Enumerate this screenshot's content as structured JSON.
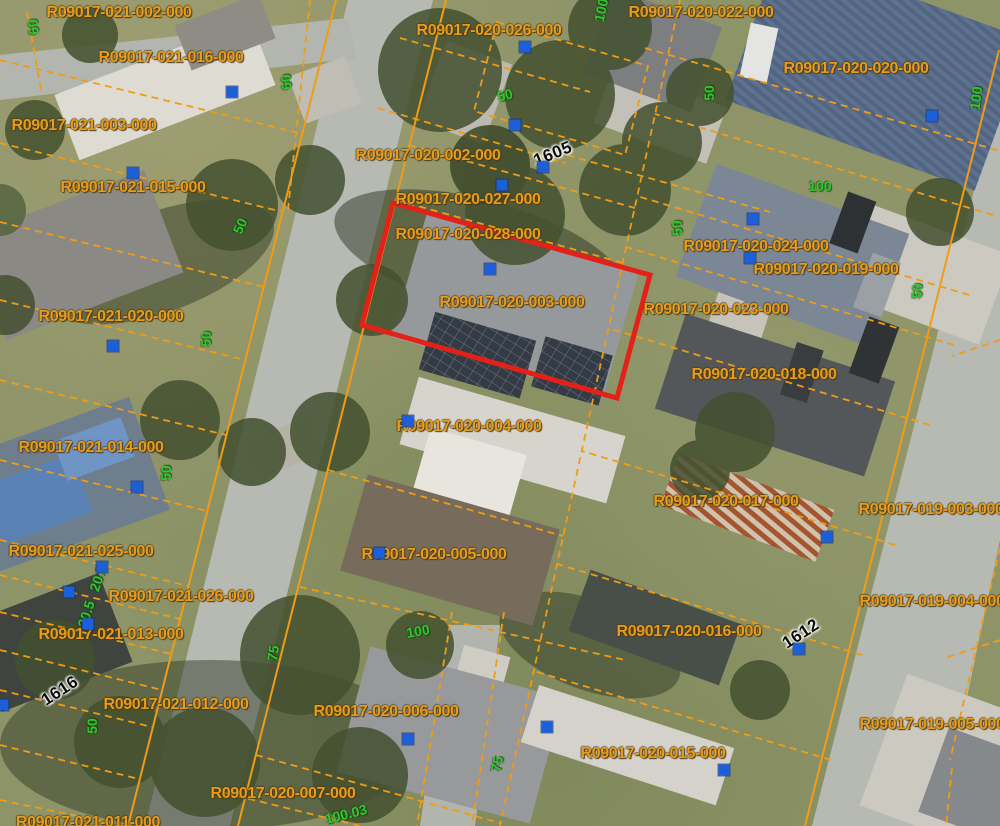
{
  "map": {
    "description": "aerial parcel map with GIS overlay",
    "colors": {
      "parcel_line": "#ef9c17",
      "parcel_label": "#e89b1c",
      "dimension_label": "#2fc82f",
      "address_label": "#0c0c0c",
      "marker": "#1d5fd8",
      "highlight": "#e32119"
    }
  },
  "highlighted_parcel": {
    "id": "R09017-020-003-000"
  },
  "parcel_labels": [
    {
      "text": "R09017-021-002-000",
      "x": 119,
      "y": 13
    },
    {
      "text": "R09017-020-026-000",
      "x": 489,
      "y": 31
    },
    {
      "text": "R09017-020-022-000",
      "x": 701,
      "y": 13
    },
    {
      "text": "R09017-021-016-000",
      "x": 171,
      "y": 58
    },
    {
      "text": "R09017-020-020-000",
      "x": 856,
      "y": 69
    },
    {
      "text": "R09017-021-003-000",
      "x": 84,
      "y": 126
    },
    {
      "text": "R09017-020-002-000",
      "x": 428,
      "y": 156
    },
    {
      "text": "R09017-021-015-000",
      "x": 133,
      "y": 188
    },
    {
      "text": "R09017-020-027-000",
      "x": 468,
      "y": 200
    },
    {
      "text": "R09017-020-028-000",
      "x": 468,
      "y": 235
    },
    {
      "text": "R09017-020-024-000",
      "x": 756,
      "y": 247
    },
    {
      "text": "R09017-020-019-000",
      "x": 826,
      "y": 270
    },
    {
      "text": "R09017-020-003-000",
      "x": 512,
      "y": 303
    },
    {
      "text": "R09017-020-023-000",
      "x": 716,
      "y": 310
    },
    {
      "text": "R09017-021-020-000",
      "x": 111,
      "y": 317
    },
    {
      "text": "R09017-020-018-000",
      "x": 764,
      "y": 375
    },
    {
      "text": "R09017-021-014-000",
      "x": 91,
      "y": 448
    },
    {
      "text": "R09017-020-004-000",
      "x": 469,
      "y": 427
    },
    {
      "text": "R09017-020-017-000",
      "x": 726,
      "y": 502
    },
    {
      "text": "R09017-019-003-000",
      "x": 931,
      "y": 510
    },
    {
      "text": "R09017-021-025-000",
      "x": 81,
      "y": 552
    },
    {
      "text": "R09017-020-005-000",
      "x": 434,
      "y": 555
    },
    {
      "text": "R09017-021-026-000",
      "x": 181,
      "y": 597
    },
    {
      "text": "R09017-019-004-000",
      "x": 932,
      "y": 602
    },
    {
      "text": "R09017-020-016-000",
      "x": 689,
      "y": 632
    },
    {
      "text": "R09017-021-013-000",
      "x": 111,
      "y": 635
    },
    {
      "text": "R09017-021-012-000",
      "x": 176,
      "y": 705
    },
    {
      "text": "R09017-020-006-000",
      "x": 386,
      "y": 712
    },
    {
      "text": "R09017-019-005-000",
      "x": 932,
      "y": 725
    },
    {
      "text": "R09017-020-015-000",
      "x": 653,
      "y": 754
    },
    {
      "text": "R09017-020-007-000",
      "x": 283,
      "y": 794
    },
    {
      "text": "R09017-021-011-000",
      "x": 88,
      "y": 823
    }
  ],
  "dimension_labels": [
    {
      "text": "60",
      "x": 33,
      "y": 27,
      "rot": -97
    },
    {
      "text": "60",
      "x": 286,
      "y": 82,
      "rot": -95
    },
    {
      "text": "100",
      "x": 601,
      "y": 10,
      "rot": -78
    },
    {
      "text": "50",
      "x": 505,
      "y": 95,
      "rot": -15
    },
    {
      "text": "50",
      "x": 709,
      "y": 93,
      "rot": -90
    },
    {
      "text": "100",
      "x": 976,
      "y": 98,
      "rot": -83
    },
    {
      "text": "100",
      "x": 820,
      "y": 186,
      "rot": 0
    },
    {
      "text": "50",
      "x": 677,
      "y": 228,
      "rot": -92
    },
    {
      "text": "50",
      "x": 240,
      "y": 226,
      "rot": -65
    },
    {
      "text": "50",
      "x": 917,
      "y": 291,
      "rot": -87
    },
    {
      "text": "50",
      "x": 206,
      "y": 339,
      "rot": -90
    },
    {
      "text": "50",
      "x": 166,
      "y": 473,
      "rot": -90
    },
    {
      "text": "20.5",
      "x": 98,
      "y": 578,
      "rot": -72
    },
    {
      "text": "20.5",
      "x": 86,
      "y": 614,
      "rot": -72
    },
    {
      "text": "100",
      "x": 418,
      "y": 631,
      "rot": -10
    },
    {
      "text": "75",
      "x": 273,
      "y": 653,
      "rot": -82
    },
    {
      "text": "50",
      "x": 92,
      "y": 726,
      "rot": -90
    },
    {
      "text": "75",
      "x": 497,
      "y": 764,
      "rot": -78
    },
    {
      "text": "100.03",
      "x": 346,
      "y": 814,
      "rot": -14
    }
  ],
  "address_labels": [
    {
      "text": "1605",
      "x": 553,
      "y": 154,
      "rot": -22
    },
    {
      "text": "1612",
      "x": 801,
      "y": 634,
      "rot": -33
    },
    {
      "text": "1616",
      "x": 60,
      "y": 691,
      "rot": -33
    }
  ],
  "markers": [
    {
      "x": 515,
      "y": 125
    },
    {
      "x": 543,
      "y": 167
    },
    {
      "x": 502,
      "y": 185
    },
    {
      "x": 232,
      "y": 92
    },
    {
      "x": 133,
      "y": 173
    },
    {
      "x": 525,
      "y": 47
    },
    {
      "x": 490,
      "y": 269
    },
    {
      "x": 753,
      "y": 219
    },
    {
      "x": 750,
      "y": 258
    },
    {
      "x": 932,
      "y": 116
    },
    {
      "x": 113,
      "y": 346
    },
    {
      "x": 137,
      "y": 487
    },
    {
      "x": 408,
      "y": 421
    },
    {
      "x": 379,
      "y": 553
    },
    {
      "x": 827,
      "y": 537
    },
    {
      "x": 102,
      "y": 567
    },
    {
      "x": 69,
      "y": 592
    },
    {
      "x": 88,
      "y": 624
    },
    {
      "x": 799,
      "y": 649
    },
    {
      "x": 408,
      "y": 739
    },
    {
      "x": 547,
      "y": 727
    },
    {
      "x": 724,
      "y": 770
    },
    {
      "x": 3,
      "y": 705
    }
  ]
}
